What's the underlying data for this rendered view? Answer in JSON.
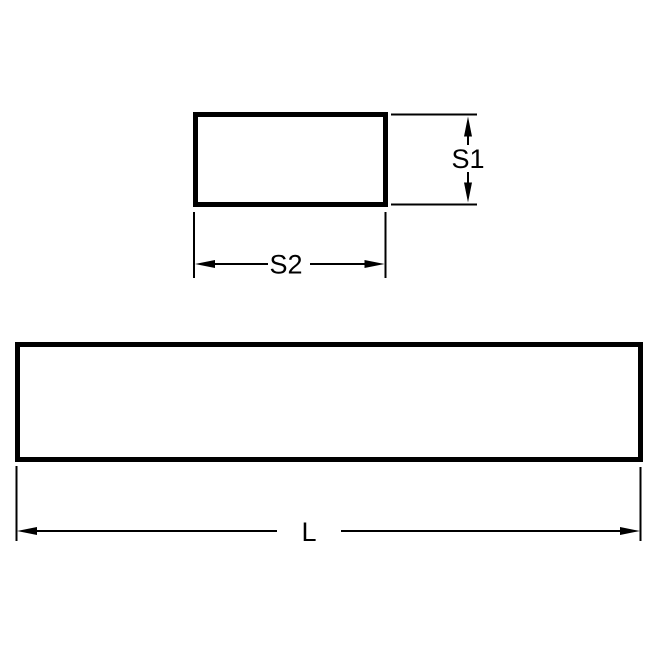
{
  "diagram": {
    "background_color": "#ffffff",
    "stroke_color": "#000000",
    "views": {
      "cross_section": {
        "label_s1": "S1",
        "label_s2": "S2"
      },
      "side_view": {
        "label_l": "L"
      }
    }
  }
}
